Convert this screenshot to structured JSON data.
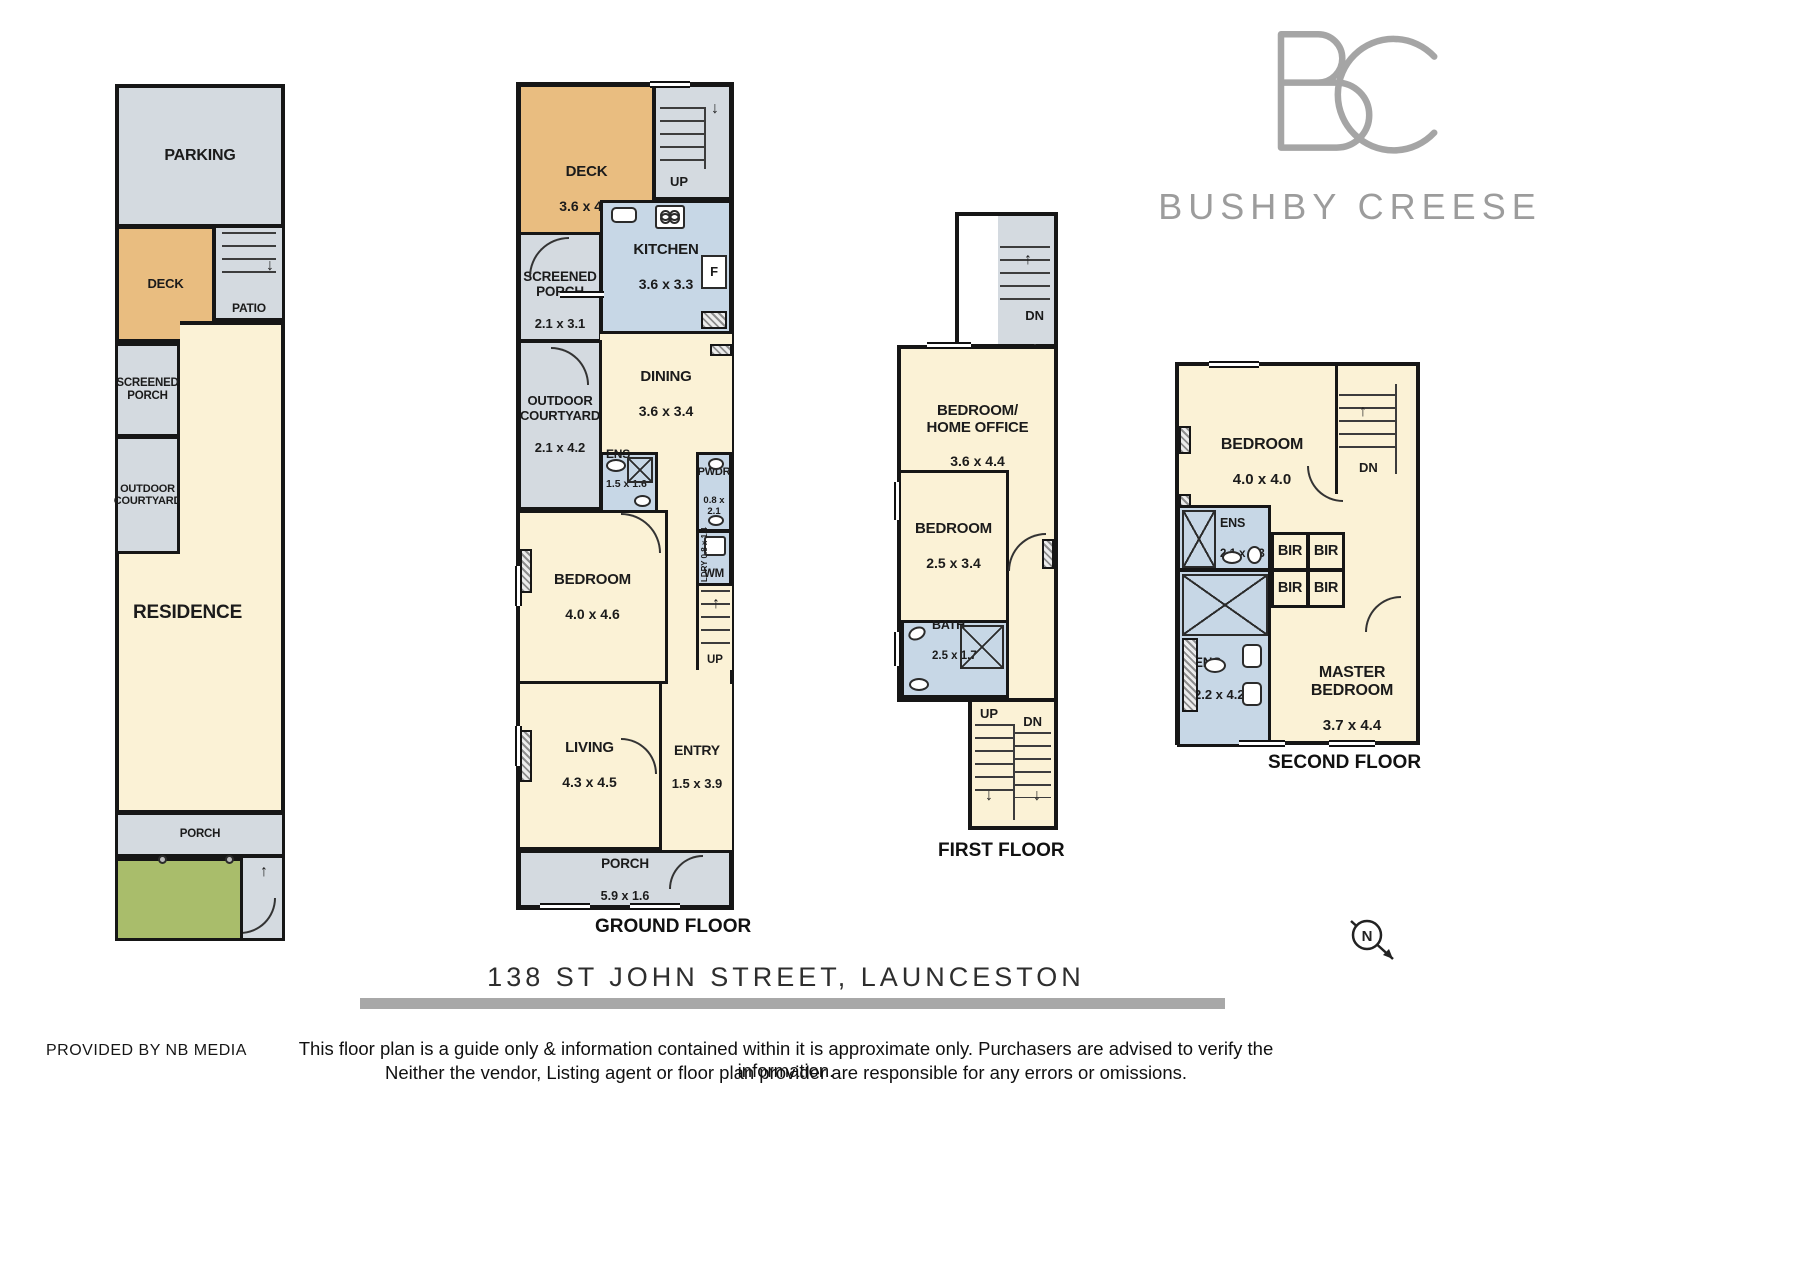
{
  "brand": {
    "initials": "BC",
    "name": "BUSHBY CREESE"
  },
  "title": {
    "address": "138 ST JOHN STREET, LAUNCESTON"
  },
  "footer": {
    "provided_by": "PROVIDED BY NB MEDIA",
    "disclaimer_line1": "This floor plan is a guide only & information contained within it is approximate only. Purchasers are advised to verify the information.",
    "disclaimer_line2": "Neither the vendor, Listing agent or floor plan provider are responsible for any errors or omissions."
  },
  "compass": {
    "label": "N"
  },
  "icons": {
    "up_arrow": "↑",
    "down_arrow": "↓"
  },
  "colors": {
    "room_cream": "#fbf2d6",
    "room_gray": "#d4dae0",
    "deck_tan": "#e9bd80",
    "wet_blue": "#c7d7e6",
    "garden_green": "#a9bd6b",
    "wall": "#161616",
    "logo_gray": "#9c9c9c",
    "rule_gray": "#a8a8a8"
  },
  "floors": {
    "site": {
      "rooms": {
        "parking": {
          "name": "PARKING"
        },
        "deck": {
          "name": "DECK"
        },
        "patio": {
          "name": "PATIO"
        },
        "screened_porch": {
          "name": "SCREENED\nPORCH"
        },
        "courtyard": {
          "name": "OUTDOOR\nCOURTYARD"
        },
        "residence": {
          "name": "RESIDENCE"
        },
        "porch": {
          "name": "PORCH"
        }
      }
    },
    "ground": {
      "label": "GROUND FLOOR",
      "labels": {
        "stairs_up": "UP",
        "fridge": "F",
        "washer": "WM",
        "laundry": "LDRY 0.8 x 1.4"
      },
      "rooms": {
        "deck": {
          "name": "DECK",
          "dims": "3.6 x 4.0"
        },
        "screened_porch": {
          "name": "SCREENED\nPORCH",
          "dims": "2.1 x 3.1"
        },
        "kitchen": {
          "name": "KITCHEN",
          "dims": "3.6 x 3.3"
        },
        "dining": {
          "name": "DINING",
          "dims": "3.6 x 3.4"
        },
        "courtyard": {
          "name": "OUTDOOR\nCOURTYARD",
          "dims": "2.1 x 4.2"
        },
        "ens": {
          "name": "ENS",
          "dims": "1.5 x 1.6"
        },
        "pwdr": {
          "name": "PWDR",
          "dims": "0.8 x 2.1"
        },
        "bedroom": {
          "name": "BEDROOM",
          "dims": "4.0 x 4.6"
        },
        "living": {
          "name": "LIVING",
          "dims": "4.3 x 4.5"
        },
        "entry": {
          "name": "ENTRY",
          "dims": "1.5 x 3.9"
        },
        "porch": {
          "name": "PORCH",
          "dims": "5.9 x 1.6"
        }
      }
    },
    "first": {
      "label": "FIRST FLOOR",
      "labels": {
        "dn": "DN",
        "up": "UP"
      },
      "rooms": {
        "home_office": {
          "name": "BEDROOM/\nHOME OFFICE",
          "dims": "3.6 x 4.4"
        },
        "bedroom": {
          "name": "BEDROOM",
          "dims": "2.5 x 3.4"
        },
        "bath": {
          "name": "BATH",
          "dims": "2.5 x 1.7"
        }
      }
    },
    "second": {
      "label": "SECOND FLOOR",
      "labels": {
        "dn": "DN",
        "bir": "BIR"
      },
      "rooms": {
        "bedroom": {
          "name": "BEDROOM",
          "dims": "4.0 x 4.0"
        },
        "ens_small": {
          "name": "ENS",
          "dims": "2.1 x 1.3"
        },
        "ens_large": {
          "name": "ENS",
          "dims": "2.2 x 4.2"
        },
        "master": {
          "name": "MASTER\nBEDROOM",
          "dims": "3.7 x 4.4"
        }
      }
    }
  }
}
